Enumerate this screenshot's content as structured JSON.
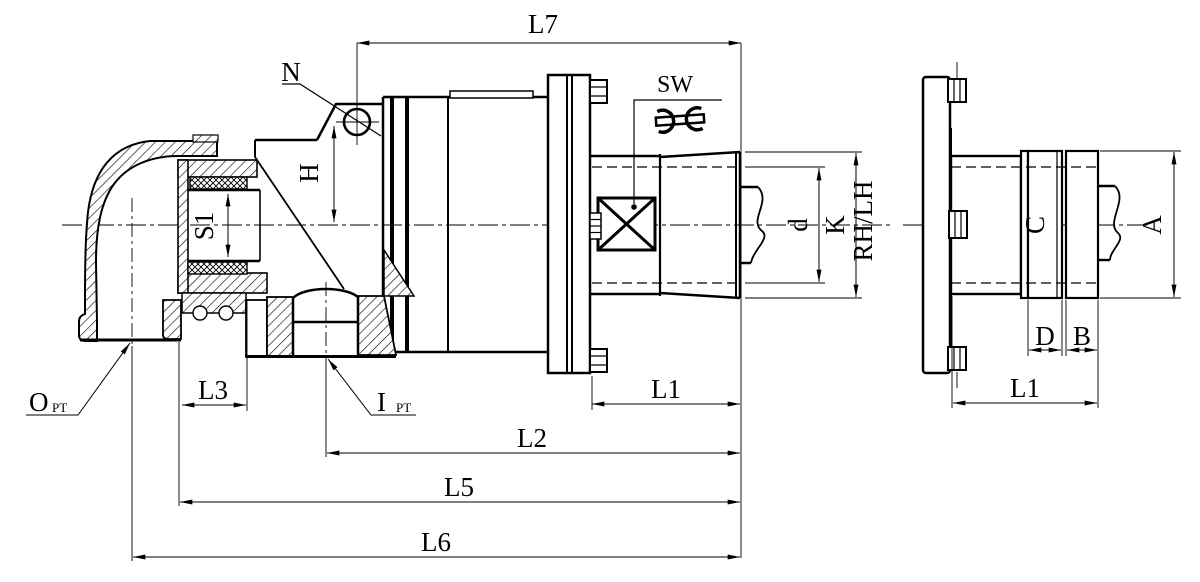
{
  "drawing": {
    "type": "technical-drawing",
    "subject": "rotary joint / swivel union cross-section with elbow, main section view and flange end view",
    "colors": {
      "ink": "#000000",
      "paper": "#ffffff"
    }
  },
  "labels": {
    "l7": "L7",
    "n": "N",
    "sw": "SW",
    "h": "H",
    "s1": "S1",
    "o": "O",
    "o_sub": "PT",
    "i": "I",
    "i_sub": "PT",
    "l3": "L3",
    "l1_main": "L1",
    "l2": "L2",
    "l5": "L5",
    "l6": "L6",
    "d": "d",
    "k": "K",
    "rh_lh": "RH/LH",
    "c": "C",
    "a": "A",
    "d_small": "D",
    "b": "B",
    "l1_side": "L1"
  },
  "icons": {
    "wrench": "open-end-wrench symbol for SW (width across flats)",
    "hex_flats": "X-cross square marking wrench flat surface"
  }
}
